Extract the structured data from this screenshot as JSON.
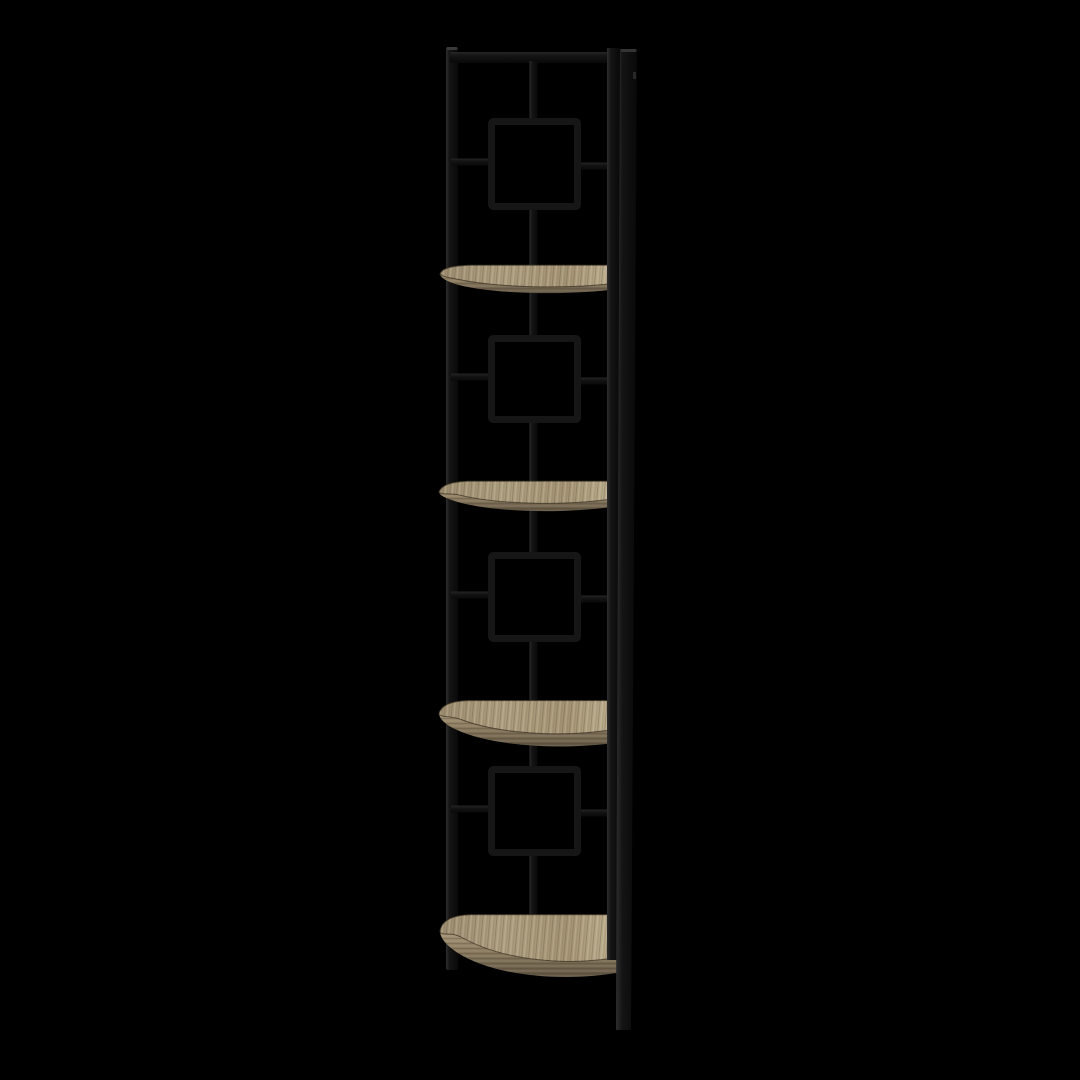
{
  "image": {
    "type": "product-photo",
    "description": "Corner etagere bookcase with a black metal frame decorated with square lattice motifs and four quarter-round taupe wood shelves, photographed on a black background"
  },
  "product": {
    "frame_material": "black metal",
    "shelf_material": "taupe reclaimed wood look",
    "shelf_count": 4,
    "square_motif_count": 4
  },
  "colors": {
    "background": "#000000",
    "frame": "#141414",
    "frame-highlight": "#2e2e2e",
    "frame-shadow": "#090909",
    "wood-light": "#c1b293",
    "wood-mid": "#ac9c7e",
    "wood-dark": "#8b7b60",
    "wood-edge-dark": "#5f5442"
  }
}
